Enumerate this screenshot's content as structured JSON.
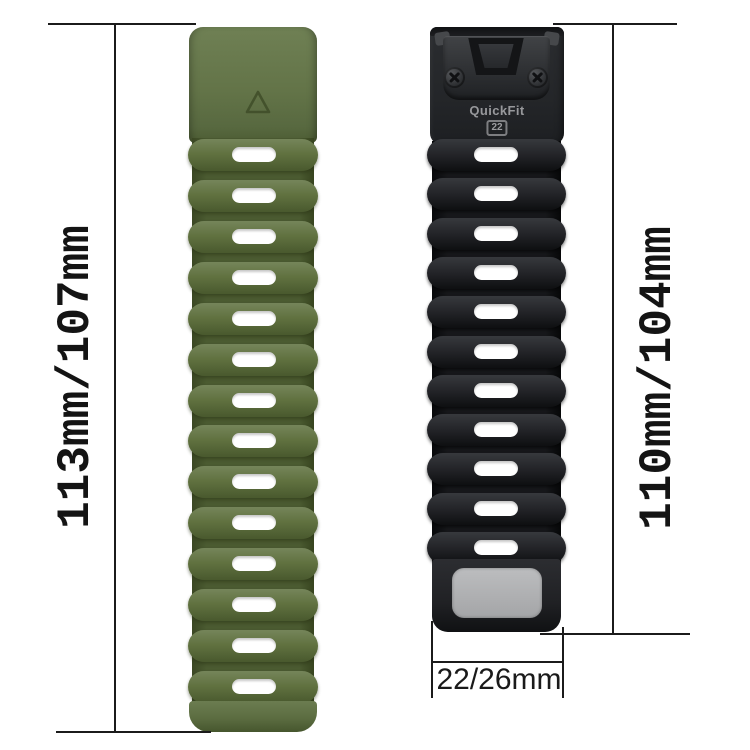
{
  "canvas": {
    "background": "#ffffff",
    "line_color": "#1b1b1b"
  },
  "annotations": {
    "left_strap_length": "113mm/107mm",
    "right_strap_length": "110mm/104mm",
    "strap_width": "22/26mm"
  },
  "straps": {
    "green": {
      "name": "army-green silicone watch band",
      "color": "#5f7044",
      "slot_count": 14,
      "logo_icon": "triangle-outline"
    },
    "black": {
      "name": "black silicone watch band with quick-release connector",
      "color": "#1e1f22",
      "slot_count": 11,
      "connector": {
        "brand": "QuickFit",
        "size_badge": "22"
      },
      "label_patch_color": "#b0b1b3"
    }
  }
}
